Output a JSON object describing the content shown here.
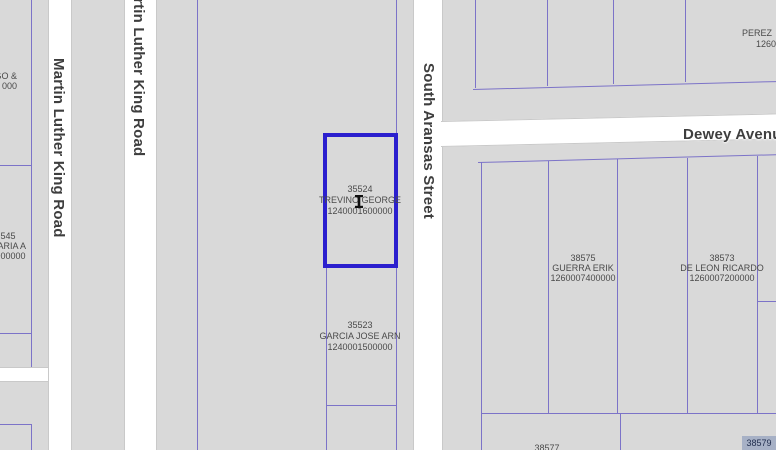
{
  "map": {
    "colors": {
      "background": "#d9d9d9",
      "road_fill": "#ffffff",
      "road_casing": "#c9c9c9",
      "parcel_line": "#7c73c8",
      "selected_outline": "#2b1fce",
      "highlight_fill": "#a7b1c6",
      "label_text": "#4a4a4a",
      "street_text": "#3e3e3e",
      "highlight_text": "#1f2c4d"
    },
    "streets": {
      "martin_luther_king_left": "Martin Luther King Road",
      "martin_luther_king_center": "rtin Luther King Road",
      "south_aransas": "South Aransas Street",
      "dewey": "Dewey Avenue"
    },
    "parcels": {
      "selected": {
        "id": "35524",
        "owner": "TREVINO GEORGE",
        "account": "1240001600000"
      },
      "garcia": {
        "id": "35523",
        "owner": "GARCIA JOSE ARN",
        "account": "1240001500000"
      },
      "guerra": {
        "id": "38575",
        "owner": "GUERRA ERIK",
        "account": "1260007400000"
      },
      "de_leon": {
        "id": "38573",
        "owner": "DE LEON RICARDO",
        "account": "1260007200000"
      },
      "perez": {
        "owner": "PEREZ",
        "account_partial": "1260"
      },
      "edge_top_left": {
        "line1": "GO &",
        "line2": "000"
      },
      "edge_mid_left": {
        "line1": "545",
        "line2": "MARIA A",
        "line3": "5900000"
      },
      "bottom_left_id": "38577",
      "bottom_right_id": "38579"
    }
  }
}
